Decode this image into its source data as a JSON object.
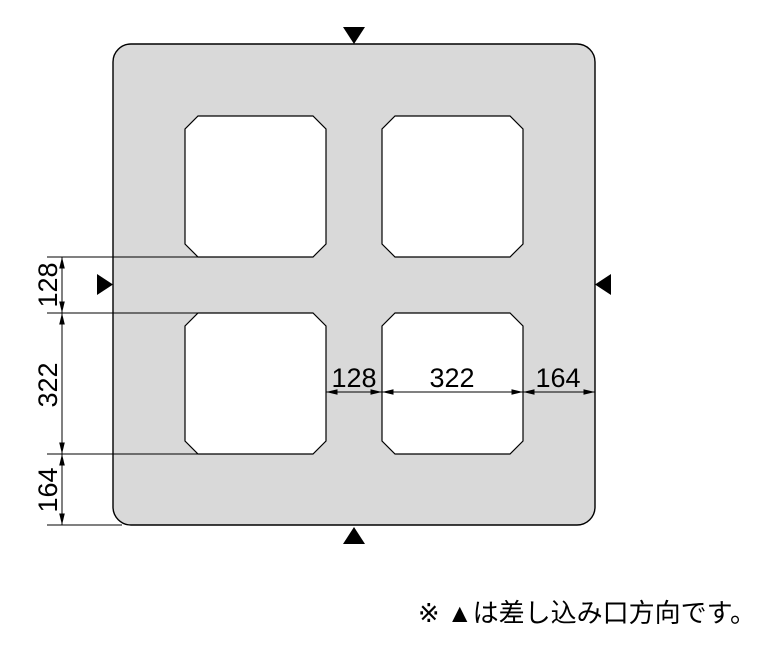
{
  "diagram": {
    "type": "block-plan-dimension-drawing",
    "colors": {
      "block_fill": "#d9d9d9",
      "line": "#000000",
      "hole_fill": "#ffffff"
    },
    "dimensions": {
      "vertical": [
        {
          "label": "128"
        },
        {
          "label": "322"
        },
        {
          "label": "164"
        }
      ],
      "horizontal": [
        {
          "label": "128"
        },
        {
          "label": "322"
        },
        {
          "label": "164"
        }
      ]
    },
    "insertion_markers": [
      {
        "position": "top"
      },
      {
        "position": "bottom"
      },
      {
        "position": "left"
      },
      {
        "position": "right"
      }
    ]
  },
  "note": {
    "text": "※ ▲は差し込み口方向です。"
  }
}
